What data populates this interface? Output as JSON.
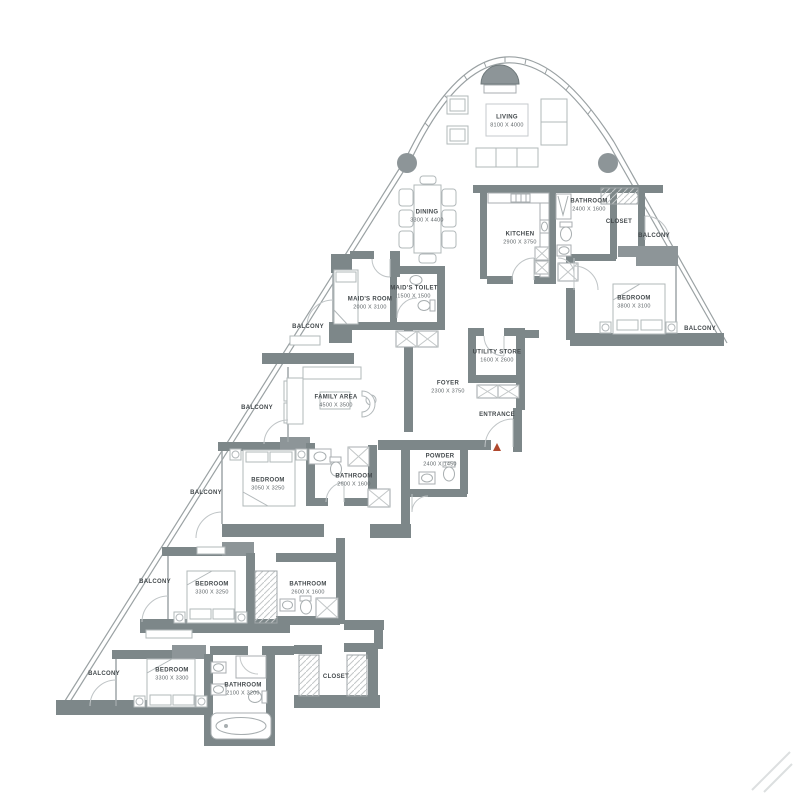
{
  "floorplan": {
    "colors": {
      "wall": "#7d8789",
      "dark_fixture": "#8d9598",
      "furniture_line": "#b2b8ba",
      "entrance_marker": "#b0492f",
      "label_text": "#43494c"
    },
    "rooms": {
      "living": {
        "name": "LIVING",
        "dims": "8100 X 4000"
      },
      "dining": {
        "name": "DINING",
        "dims": "3300 X 4400"
      },
      "kitchen": {
        "name": "KITCHEN",
        "dims": "2900 X 3750"
      },
      "bathroom_top": {
        "name": "BATHROOM",
        "dims": "2400 X 1600"
      },
      "closet_top": {
        "name": "CLOSET"
      },
      "balcony_top_right": {
        "name": "BALCONY"
      },
      "bedroom_right": {
        "name": "BEDROOM",
        "dims": "3800 X 3100"
      },
      "balcony_right": {
        "name": "BALCONY"
      },
      "maids_room": {
        "name": "MAID'S ROOM",
        "dims": "2000 X 3100"
      },
      "maids_toilet": {
        "name": "MAID'S TOILET",
        "dims": "1500 X 1500"
      },
      "balcony_maid": {
        "name": "BALCONY"
      },
      "utility_store": {
        "name": "UTILITY STORE",
        "dims": "1600 X 2600"
      },
      "foyer": {
        "name": "FOYER",
        "dims": "2300 X 3750"
      },
      "entrance": {
        "name": "ENTRANCE"
      },
      "family_area": {
        "name": "FAMILY AREA",
        "dims": "4500 X 3500"
      },
      "balcony_family": {
        "name": "BALCONY"
      },
      "powder": {
        "name": "POWDER",
        "dims": "2400 X 1450"
      },
      "bedroom_2": {
        "name": "BEDROOM",
        "dims": "3050 X 3250"
      },
      "bathroom_2": {
        "name": "BATHROOM",
        "dims": "2600 X 1600"
      },
      "balcony_bed2": {
        "name": "BALCONY"
      },
      "bedroom_3": {
        "name": "BEDROOM",
        "dims": "3300 X 3250"
      },
      "bathroom_3": {
        "name": "BATHROOM",
        "dims": "2600 X 1600"
      },
      "balcony_bed3": {
        "name": "BALCONY"
      },
      "bedroom_4": {
        "name": "BEDROOM",
        "dims": "3300 X 3300"
      },
      "bathroom_4": {
        "name": "BATHROOM",
        "dims": "2100 X 3200"
      },
      "closet_bottom": {
        "name": "CLOSET"
      },
      "balcony_bed4": {
        "name": "BALCONY"
      }
    }
  }
}
